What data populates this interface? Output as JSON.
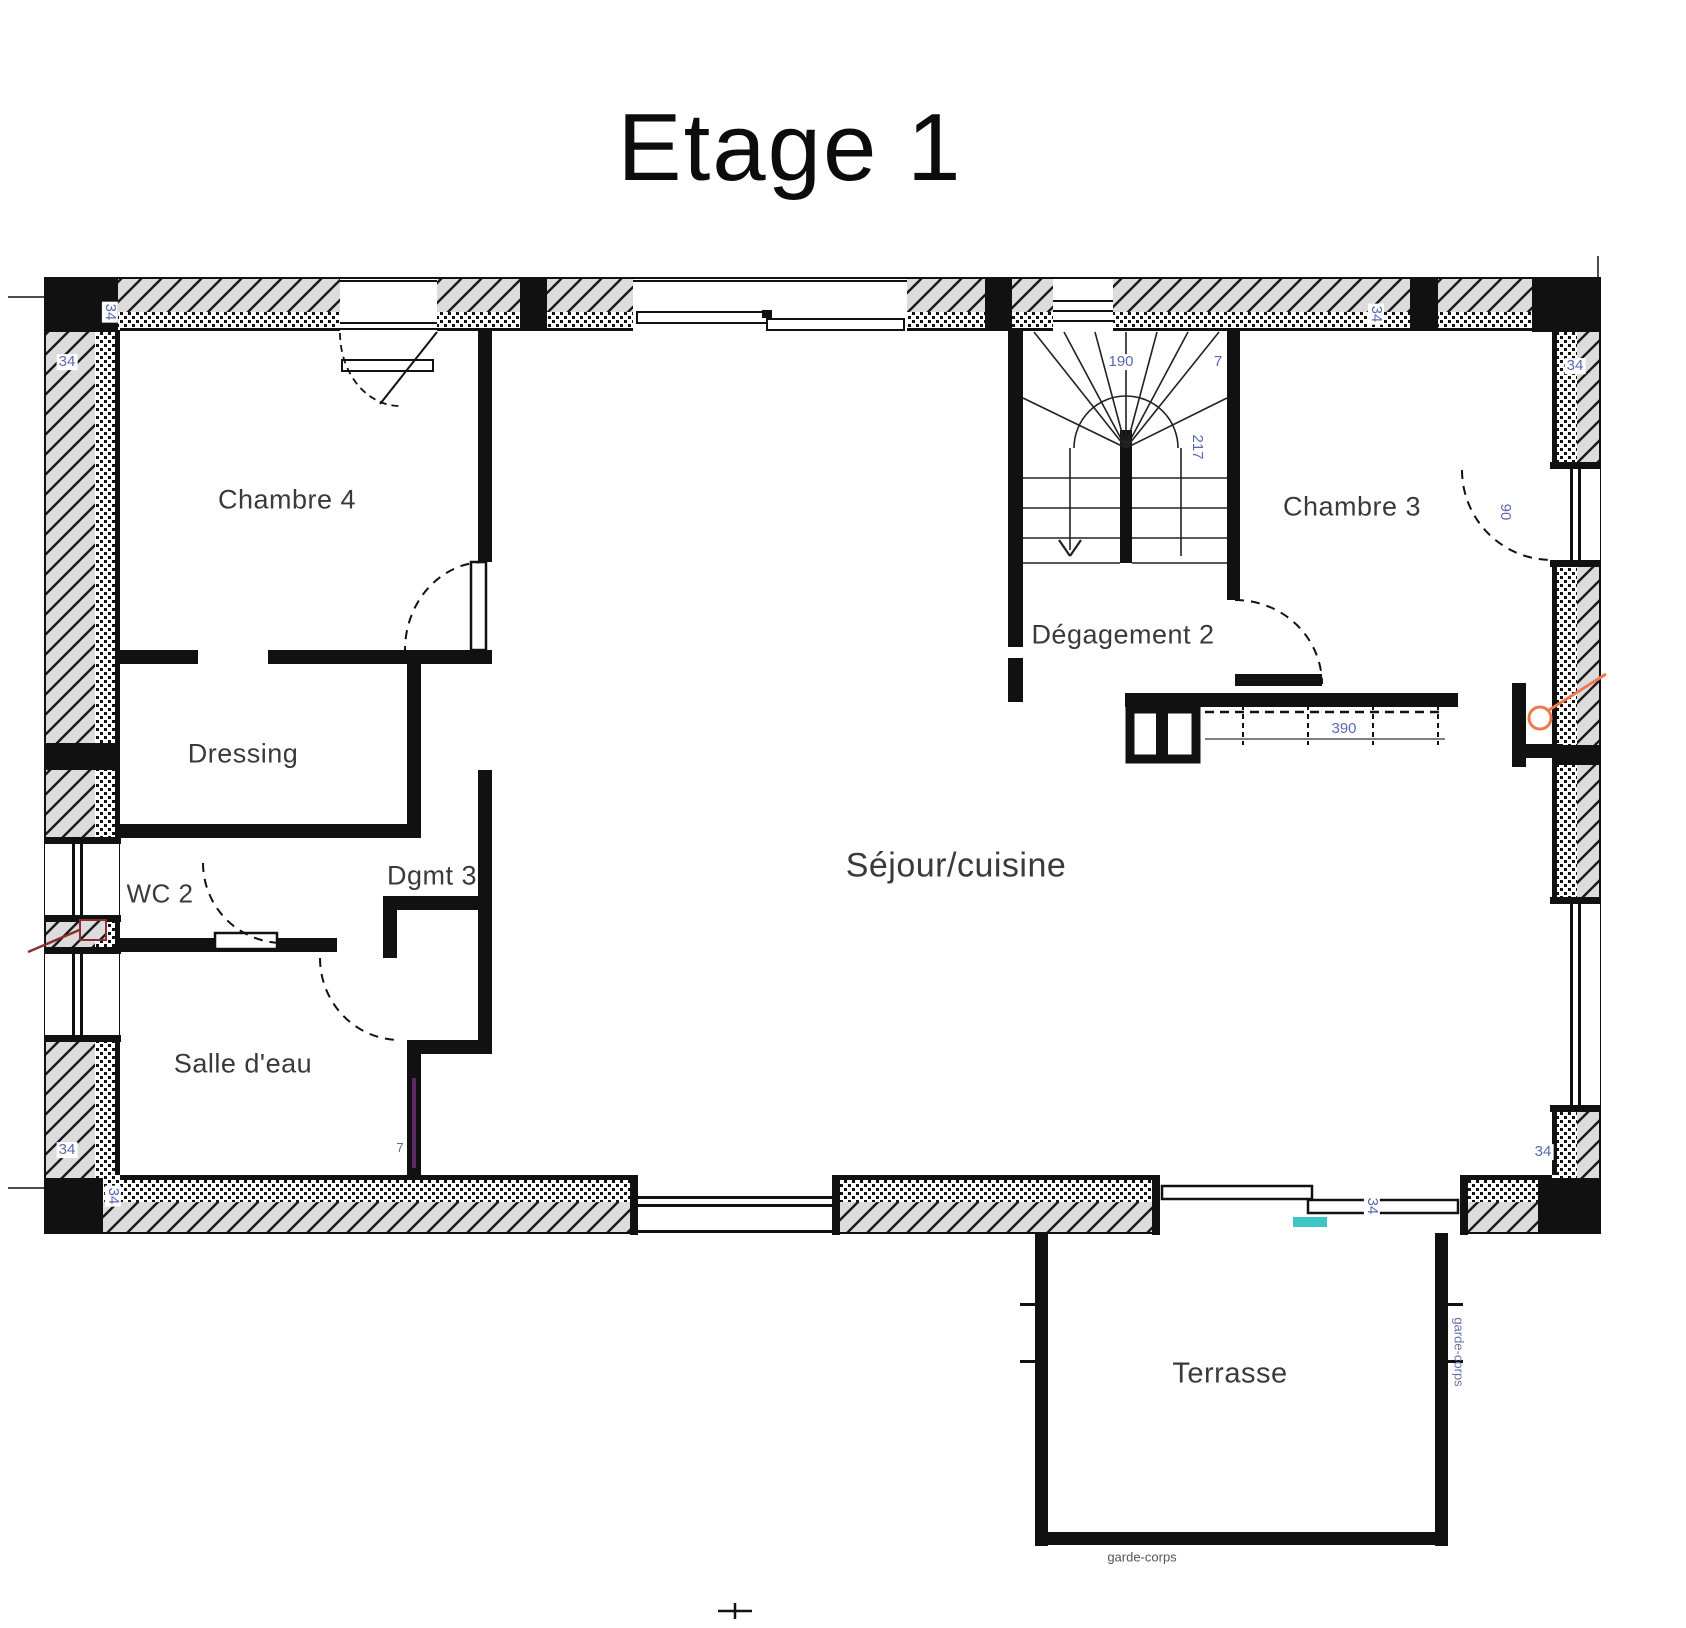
{
  "title": "Etage 1",
  "rooms": {
    "chambre4": "Chambre 4",
    "dressing": "Dressing",
    "wc2": "WC 2",
    "dgmt3": "Dgmt 3",
    "salle_deau": "Salle d'eau",
    "sejour_cuisine": "Séjour/cuisine",
    "degagement2": "Dégagement 2",
    "chambre3": "Chambre 3",
    "terrasse": "Terrasse"
  },
  "dims": {
    "wall_34": "34",
    "stair_width_190": "190",
    "count_7": "7",
    "stair_length_217": "217",
    "closet_390": "390",
    "door_90": "90"
  },
  "annotations": {
    "guardrail": "garde-corps"
  },
  "colors": {
    "dimension_text": "#5a68b0",
    "orange_marker": "#ef7a50",
    "cyan_marker": "#3ec6c6",
    "purple_marker": "#5c2a66",
    "red_marker": "#8b2e2e",
    "hatch_gray": "#dcdcdc"
  }
}
